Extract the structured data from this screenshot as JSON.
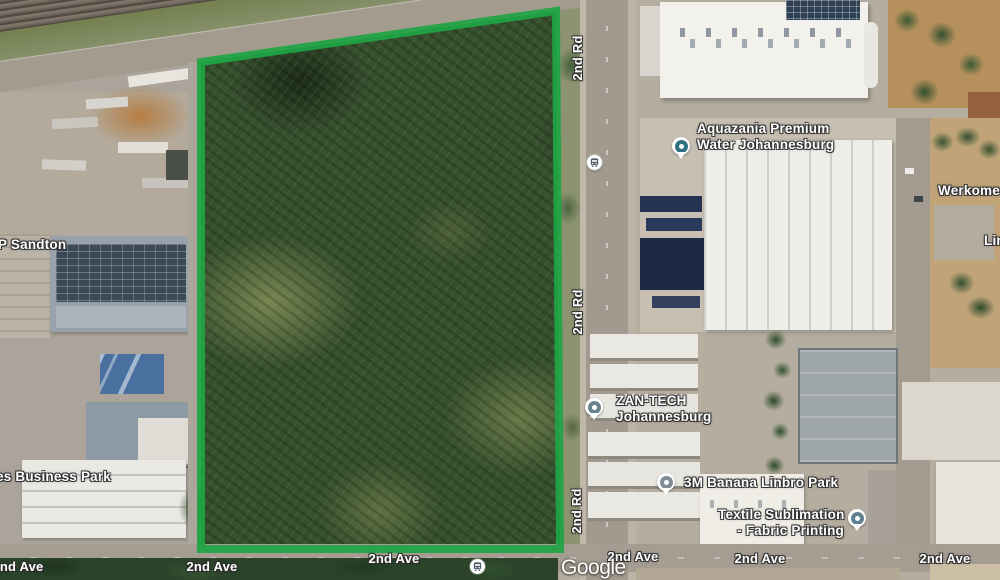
{
  "map": {
    "watermark": "Google",
    "boundary_color": "#1ea544",
    "streets": {
      "rd": "2nd Rd",
      "ave": "2nd Ave"
    },
    "places": {
      "aquazania": {
        "line1": "Aquazania Premium",
        "line2": "Water Johannesburg",
        "pin_color": "#2e7080"
      },
      "werkome": {
        "label": "Werkome"
      },
      "linbro_partial": {
        "label": "Lin"
      },
      "p_sandton": {
        "label": "P Sandton"
      },
      "business_park": {
        "label": "es Business Park"
      },
      "zantech": {
        "line1": "ZAN-TECH",
        "line2": "Johannesburg",
        "pin_color": "#69848f"
      },
      "banana_3m": {
        "label": "3M Banana Linbro Park",
        "pin_color": "#7e8d95"
      },
      "textile": {
        "line1": "Textile Sublimation",
        "line2": "- Fabric Printing",
        "pin_color": "#5e8090"
      }
    },
    "transit_icon": "bus-stop"
  }
}
